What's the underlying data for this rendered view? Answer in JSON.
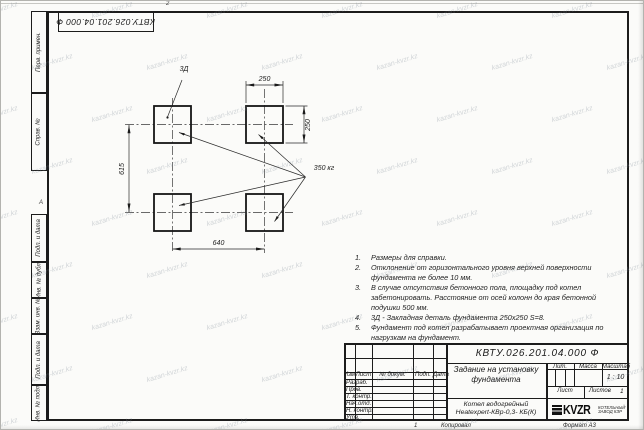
{
  "watermark": {
    "text": "kazan-kvzr.kz"
  },
  "top_stamp": {
    "designation_rotated": "КВТУ.026.201.04.000 Ф"
  },
  "margin_columns": {
    "perv_primen": "Перв. примен.",
    "sprav_no": "Справ. №",
    "podp_data_1": "Подп. и дата",
    "inv_dubl": "Инв. № дубл.",
    "vzam_inv": "Взам. инв. №",
    "podp_data_2": "Подп. и дата",
    "inv_podl": "Инв. № подл.",
    "zone_top": "2",
    "zone_left": "А"
  },
  "drawing": {
    "pad_label": "3Д",
    "weight_label": "350 кг",
    "dim_top": "250",
    "dim_right": "250",
    "dim_left": "615",
    "dim_bottom": "640"
  },
  "notes": [
    {
      "num": "1.",
      "text": "Размеры для справки."
    },
    {
      "num": "2.",
      "text": "Отклонение от горизонтального уровня верхней поверхности фундамента не более 10 мм."
    },
    {
      "num": "3.",
      "text": "В случае отсутствия бетонного пола, площадку под котел забетонировать. Расстояние от осей колонн до края бетонной подушки 500 мм."
    },
    {
      "num": "4.",
      "text": "3Д - Закладная деталь фундамента 250х250 S=8."
    },
    {
      "num": "5.",
      "text": "Фундамент под котел разрабатывает проектная организация по нагрузкам на фундамент."
    }
  ],
  "title_block": {
    "designation": "КВТУ.026.201.04.000 Ф",
    "doc_title_line1": "Задание на установку",
    "doc_title_line2": "фундамента",
    "header_cols": [
      "Изм",
      "Лист",
      "№ докум.",
      "Подп.",
      "Дата"
    ],
    "sign_rows": [
      "Разраб.",
      "Пров.",
      "Т. контр.",
      "Нач.отд.",
      "Н. контр.",
      "Утв."
    ],
    "lit_label": "Лит.",
    "mass_label": "Масса",
    "scale_label": "Масштаб",
    "scale_value": "1 : 10",
    "sheet_label": "Лист",
    "sheets_label": "Листов",
    "sheets_value": "1",
    "product_line1": "Котел водогрейный",
    "product_line2": "Heatexpert-КВр-0,3- КБ(К)",
    "logo_text": "KVZR",
    "logo_caption_line1": "КОТЕЛЬНЫЙ",
    "logo_caption_line2": "ЗАВОД КЗР"
  },
  "footer": {
    "copy_no": "1",
    "copied": "Копировал",
    "format": "Формат А3"
  }
}
